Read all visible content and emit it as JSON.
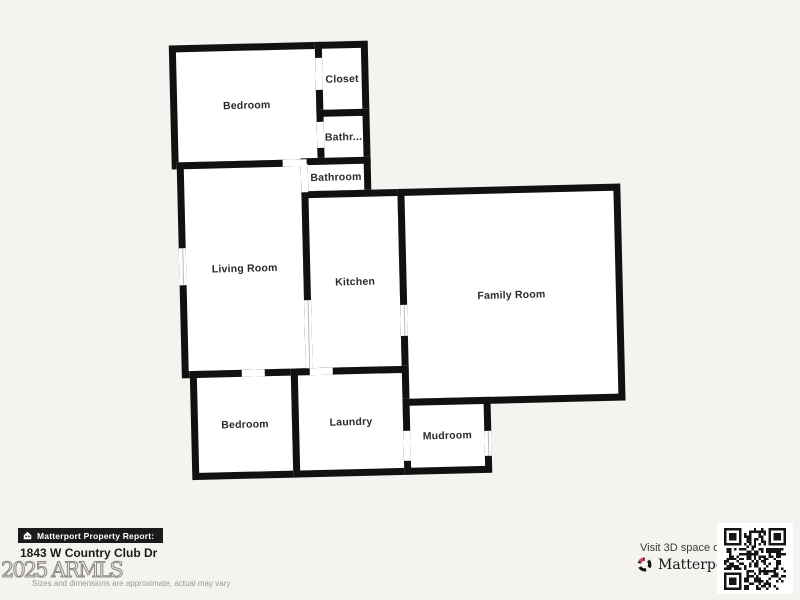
{
  "colors": {
    "background": "#f4f3f0",
    "wall": "#111111",
    "room_fill": "#ffffff",
    "badge_bg": "#1d1b1a",
    "brand_pink": "#ef3b5d",
    "qr_dark": "#141414"
  },
  "floor_plan": {
    "rooms": [
      {
        "id": "bedroom-top",
        "label": "Bedroom",
        "x": 0,
        "y": 0,
        "w": 153,
        "h": 124
      },
      {
        "id": "closet",
        "label": "Closet",
        "x": 146,
        "y": 0,
        "w": 53,
        "h": 75
      },
      {
        "id": "bathroom-small",
        "label": "Bathr...",
        "x": 146,
        "y": 68,
        "w": 53,
        "h": 56
      },
      {
        "id": "living-room",
        "label": "Living Room",
        "x": 5,
        "y": 117,
        "w": 131,
        "h": 216
      },
      {
        "id": "bathroom",
        "label": "Bathroom",
        "x": 129,
        "y": 116,
        "w": 70,
        "h": 40
      },
      {
        "id": "kitchen",
        "label": "Kitchen",
        "x": 129,
        "y": 149,
        "w": 103,
        "h": 184
      },
      {
        "id": "family-room",
        "label": "Family Room",
        "x": 225,
        "y": 149,
        "w": 223,
        "h": 217
      },
      {
        "id": "bedroom-bottom",
        "label": "Bedroom",
        "x": 13,
        "y": 326,
        "w": 108,
        "h": 109
      },
      {
        "id": "laundry",
        "label": "Laundry",
        "x": 114,
        "y": 326,
        "w": 118,
        "h": 109
      },
      {
        "id": "mudroom",
        "label": "Mudroom",
        "x": 225,
        "y": 359,
        "w": 88,
        "h": 76
      }
    ],
    "openings": [
      {
        "id": "closet-door",
        "x": 146,
        "y": 16,
        "w": 7,
        "h": 32,
        "win": false
      },
      {
        "id": "bathroom-small-door",
        "x": 146,
        "y": 80,
        "w": 7,
        "h": 26,
        "win": false
      },
      {
        "id": "bedroom-top-doorway",
        "x": 111,
        "y": 117,
        "w": 24,
        "h": 7,
        "win": false
      },
      {
        "id": "bathroom-door",
        "x": 129,
        "y": 122,
        "w": 7,
        "h": 28,
        "win": false
      },
      {
        "id": "living-room-window",
        "x": 5,
        "y": 203,
        "w": 7,
        "h": 37,
        "win": true,
        "dir": "v"
      },
      {
        "id": "kitchen-family-doorway",
        "x": 225,
        "y": 265,
        "w": 7,
        "h": 31,
        "win": true,
        "dir": "v"
      },
      {
        "id": "kitchen-doorway",
        "x": 133,
        "y": 326,
        "w": 23,
        "h": 7,
        "win": false
      },
      {
        "id": "bedroom-bottom-doorway",
        "x": 65,
        "y": 326,
        "w": 23,
        "h": 7,
        "win": false
      },
      {
        "id": "mudroom-left-door",
        "x": 225,
        "y": 391,
        "w": 7,
        "h": 30,
        "win": false
      },
      {
        "id": "mudroom-right-window",
        "x": 306,
        "y": 393,
        "w": 7,
        "h": 25,
        "win": true,
        "dir": "v"
      },
      {
        "id": "kitchen-living-divider",
        "x": 129,
        "y": 258,
        "w": 7,
        "h": 68,
        "win": true,
        "dir": "v"
      }
    ]
  },
  "footer": {
    "report_badge": "Matterport Property Report:",
    "badge_icon": "house-icon",
    "address": "1843 W Country Club Dr",
    "watermark": "2025 ARMLS",
    "disclaimer": "Sizes and dimensions are approximate, actual may vary",
    "visit_text": "Visit 3D space on",
    "brand": "Matterport",
    "brand_tm": "™",
    "brand_icon": "matterport-logo-icon",
    "qr_icon": "qr-code"
  }
}
